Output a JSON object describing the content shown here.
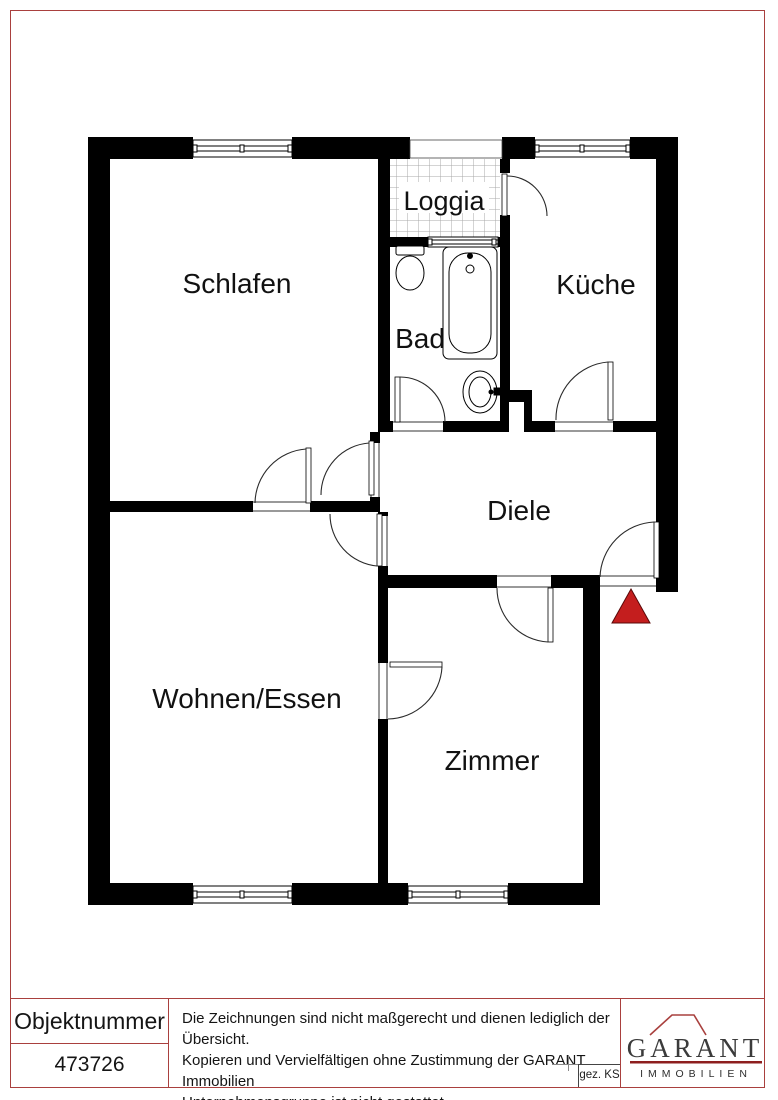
{
  "plan": {
    "rooms": {
      "schlafen": "Schlafen",
      "loggia": "Loggia",
      "kueche": "Küche",
      "bad": "Bad",
      "diele": "Diele",
      "wohnen": "Wohnen/Essen",
      "zimmer": "Zimmer"
    }
  },
  "footer": {
    "object_number_label": "Objektnummer",
    "object_number_value": "473726",
    "disclaimer_lines": [
      "Die Zeichnungen sind nicht maßgerecht und dienen lediglich der Übersicht.",
      "Kopieren und Vervielfältigen ohne Zustimmung der GARANT Immobilien",
      "Unternehmensgruppe ist nicht gestattet."
    ],
    "drawn_by": "gez. KS",
    "logo": {
      "name": "GARANT",
      "subtitle": "IMMOBILIEN"
    }
  },
  "colors": {
    "border_red": "#a9403e",
    "arrow_red": "#c41e1e",
    "wall_black": "#000000",
    "logo_text": "#3b3b3b",
    "logo_red": "#8e1f1f"
  }
}
